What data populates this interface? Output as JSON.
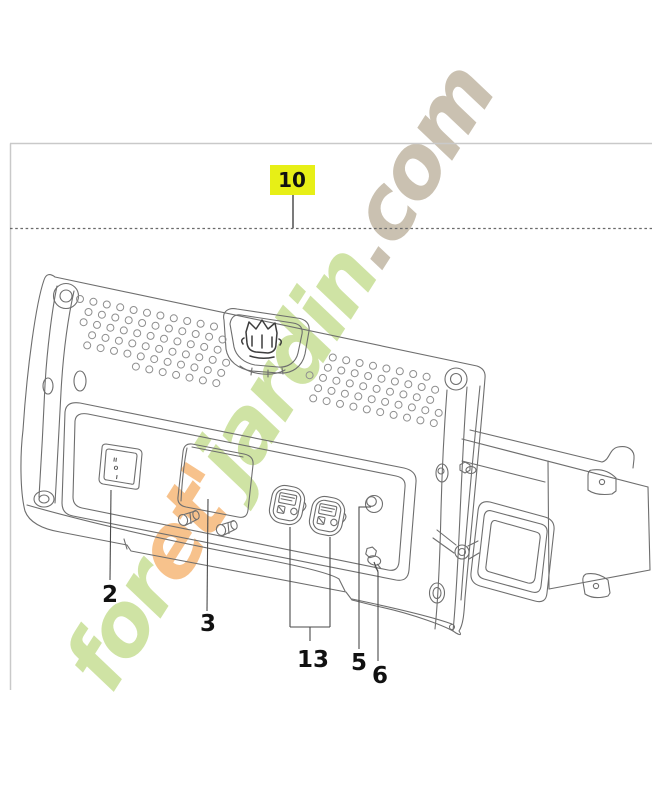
{
  "page": {
    "background": "#ffffff",
    "frame_border_color": "#c9c9c9",
    "dashed_line_color": "#6a6a6a",
    "drawing_line_color": "#6e6e6e"
  },
  "watermark": {
    "full_text": "foret'jardin.com",
    "segments": [
      {
        "text": "for",
        "color": "#cfe3a4"
      },
      {
        "text": "et'",
        "color": "#f7c28c"
      },
      {
        "text": "jardin",
        "color": "#cfe3a4"
      },
      {
        "text": ".com",
        "color": "#cac1b1"
      }
    ]
  },
  "diagram": {
    "highlighted_callout": {
      "label": "10",
      "background": "#e7ef16",
      "text_color": "#111111"
    },
    "callouts": [
      {
        "label": "2"
      },
      {
        "label": "3"
      },
      {
        "label": "13"
      },
      {
        "label": "5"
      },
      {
        "label": "6"
      }
    ],
    "rocker_switch_markings": [
      "II",
      "O",
      "I"
    ]
  }
}
